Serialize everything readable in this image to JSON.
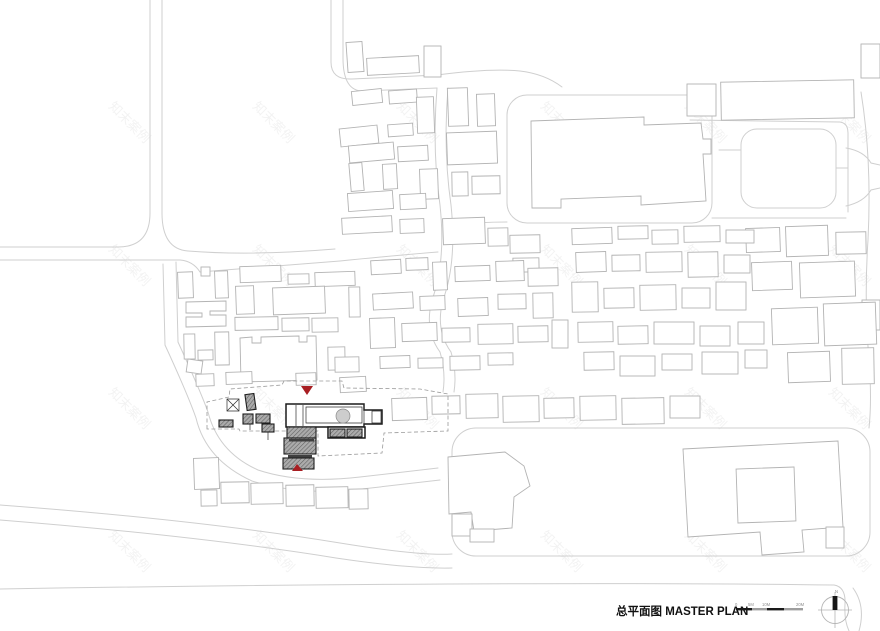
{
  "meta": {
    "title": "总平面图 MASTER PLAN"
  },
  "colors": {
    "accent_red": "#a81e22",
    "building_stroke": "#b3b3b3",
    "road_stroke": "#cfcfcf",
    "site_black": "#1a1a1a",
    "roof_gray": "#ababab"
  },
  "legend": {
    "north_label": "N",
    "scale_labels": [
      "0",
      "5M",
      "10M",
      "20M"
    ]
  },
  "watermark": {
    "text": "知末案例",
    "cols": [
      108,
      252,
      396,
      540,
      684,
      828
    ],
    "rows": [
      107,
      250,
      393,
      536
    ]
  },
  "map": {
    "layers": [
      {
        "name": "road",
        "cls": "road",
        "paths": [
          "M0,247 H118 Q150,247 150,213 V0",
          "M0,260 H180 Q193,261 200,272",
          "M162,0 V213 Q162,249 188,251 Q250,256 335,249",
          "M200,272 Q260,267 340,261 Q400,255 438,252",
          "M331,0 V62 Q331,80 352,79 L437,75",
          "M343,0 V58 Q343,92 364,91 L437,88",
          "M437,75 Q490,68 520,71 Q545,74 562,87",
          "M437,88 Q432,150 440,205 Q446,262 432,300 Q424,330 440,352",
          "M448,88 Q443,150 451,205 Q457,262 443,300 Q435,330 451,352",
          "M440,352 Q446,372 443,392",
          "M451,352 Q457,372 454,392",
          "M690,120 L840,122 Q848,123 848,133 V212",
          "M712,218 L846,218",
          "M451,225 Q480,222 507,222",
          "M846,148 Q864,151 871,163 L880,165",
          "M846,206 Q864,202 871,190 L880,188",
          "M861,92 Q872,160 868,240 Q864,300 869,360 Q872,400 869,428",
          "M176,262 Q177,305 178,342",
          "M163,264 Q164,308 165,345",
          "M178,342 Q200,390 208,412 Q218,452 258,470 Q300,484 360,477 L438,468",
          "M165,345 Q188,395 196,418 Q206,460 252,481 Q300,496 362,489 L440,480",
          "M0,505 Q200,520 340,543 Q420,556 452,554",
          "M0,520 Q200,536 336,558 Q410,569 452,568",
          "M719,150 H741",
          "M836,168 H848",
          "M0,589 C300,584 620,582 834,585 Q846,587 845,604 Q844,620 849,631",
          "M853,588 Q866,606 859,631"
        ],
        "rects": [
          [
            507,
            95,
            205,
            128,
            0,
            20
          ],
          [
            741,
            129,
            95,
            79,
            0,
            16
          ],
          [
            452,
            428,
            418,
            128,
            0,
            24
          ]
        ]
      },
      {
        "name": "building-footprint",
        "cls": "bldg",
        "rects": [
          [
            347,
            42,
            16,
            30,
            -4
          ],
          [
            367,
            57,
            52,
            17,
            -3
          ],
          [
            424,
            46,
            17,
            31,
            0
          ],
          [
            352,
            90,
            30,
            14,
            -6
          ],
          [
            389,
            90,
            28,
            13,
            -4
          ],
          [
            417,
            97,
            17,
            36,
            -2
          ],
          [
            340,
            127,
            38,
            18,
            -6
          ],
          [
            388,
            124,
            25,
            12,
            -4
          ],
          [
            349,
            144,
            45,
            17,
            -5
          ],
          [
            398,
            146,
            30,
            15,
            -3
          ],
          [
            350,
            163,
            13,
            28,
            -5
          ],
          [
            383,
            164,
            14,
            25,
            -3
          ],
          [
            420,
            169,
            18,
            30,
            -2
          ],
          [
            348,
            192,
            45,
            18,
            -4
          ],
          [
            400,
            194,
            26,
            15,
            -3
          ],
          [
            342,
            217,
            50,
            16,
            -3
          ],
          [
            400,
            219,
            24,
            14,
            -2
          ],
          [
            448,
            88,
            20,
            38,
            -2
          ],
          [
            477,
            94,
            18,
            32,
            -2
          ],
          [
            447,
            132,
            50,
            32,
            -2
          ],
          [
            452,
            172,
            16,
            24,
            -1
          ],
          [
            472,
            176,
            28,
            18,
            -1
          ],
          [
            443,
            218,
            42,
            26,
            -2
          ],
          [
            488,
            228,
            20,
            18,
            -1
          ],
          [
            510,
            235,
            30,
            18,
            -1
          ],
          [
            513,
            258,
            26,
            14,
            -1
          ],
          [
            687,
            84,
            29,
            32,
            0
          ],
          [
            721,
            81,
            133,
            38,
            -1
          ],
          [
            861,
            44,
            19,
            34,
            0
          ],
          [
            746,
            228,
            34,
            24,
            -2
          ],
          [
            786,
            226,
            42,
            30,
            -2
          ],
          [
            836,
            232,
            30,
            22,
            -1
          ],
          [
            752,
            262,
            40,
            28,
            -2
          ],
          [
            800,
            262,
            55,
            35,
            -2
          ],
          [
            862,
            300,
            18,
            30,
            0
          ],
          [
            772,
            308,
            46,
            36,
            -2
          ],
          [
            824,
            303,
            52,
            42,
            -2
          ],
          [
            788,
            352,
            42,
            30,
            -2
          ],
          [
            842,
            348,
            32,
            36,
            -1
          ],
          [
            178,
            272,
            15,
            26,
            -2
          ],
          [
            201,
            267,
            9,
            9,
            0
          ],
          [
            215,
            271,
            13,
            27,
            -2
          ],
          [
            240,
            266,
            41,
            16,
            -2
          ],
          [
            288,
            274,
            21,
            10,
            -1
          ],
          [
            315,
            272,
            40,
            14,
            -2
          ],
          [
            236,
            286,
            18,
            28,
            -2
          ],
          [
            273,
            287,
            52,
            27,
            -2
          ],
          [
            349,
            287,
            11,
            30,
            -1
          ],
          [
            235,
            317,
            43,
            13,
            -1
          ],
          [
            282,
            318,
            27,
            13,
            -1
          ],
          [
            312,
            318,
            26,
            14,
            -1
          ],
          [
            184,
            334,
            11,
            25,
            -1
          ],
          [
            215,
            332,
            14,
            33,
            -1
          ],
          [
            198,
            350,
            15,
            10,
            -1
          ],
          [
            187,
            360,
            15,
            13,
            8
          ],
          [
            328,
            347,
            17,
            23,
            -1
          ],
          [
            335,
            357,
            24,
            15,
            -1
          ],
          [
            371,
            260,
            30,
            14,
            -3
          ],
          [
            406,
            258,
            22,
            12,
            -2
          ],
          [
            433,
            262,
            14,
            28,
            -2
          ],
          [
            455,
            266,
            35,
            15,
            -2
          ],
          [
            496,
            261,
            28,
            20,
            -2
          ],
          [
            528,
            268,
            30,
            18,
            -1
          ],
          [
            373,
            293,
            40,
            16,
            -3
          ],
          [
            420,
            296,
            25,
            14,
            -2
          ],
          [
            458,
            298,
            30,
            18,
            -2
          ],
          [
            498,
            294,
            28,
            15,
            -1
          ],
          [
            533,
            293,
            20,
            25,
            -1
          ],
          [
            370,
            318,
            25,
            30,
            -2
          ],
          [
            402,
            323,
            35,
            18,
            -2
          ],
          [
            442,
            328,
            28,
            14,
            -1
          ],
          [
            478,
            324,
            35,
            20,
            -1
          ],
          [
            518,
            326,
            30,
            16,
            -1
          ],
          [
            552,
            320,
            16,
            28,
            0
          ],
          [
            380,
            356,
            30,
            12,
            -2
          ],
          [
            418,
            358,
            25,
            10,
            -1
          ],
          [
            450,
            356,
            30,
            14,
            -1
          ],
          [
            488,
            353,
            25,
            12,
            -1
          ],
          [
            392,
            398,
            35,
            22,
            -2
          ],
          [
            432,
            396,
            28,
            18,
            -1
          ],
          [
            466,
            394,
            32,
            24,
            -1
          ],
          [
            503,
            396,
            36,
            26,
            -1
          ],
          [
            544,
            398,
            30,
            20,
            -1
          ],
          [
            580,
            396,
            36,
            24,
            -1
          ],
          [
            622,
            398,
            42,
            26,
            -1
          ],
          [
            670,
            396,
            30,
            22,
            0
          ],
          [
            572,
            228,
            40,
            16,
            -2
          ],
          [
            618,
            226,
            30,
            13,
            -1
          ],
          [
            652,
            230,
            26,
            14,
            -1
          ],
          [
            684,
            226,
            36,
            16,
            -1
          ],
          [
            726,
            230,
            28,
            13,
            0
          ],
          [
            576,
            252,
            30,
            20,
            -2
          ],
          [
            612,
            255,
            28,
            16,
            -1
          ],
          [
            646,
            252,
            36,
            20,
            -1
          ],
          [
            688,
            252,
            30,
            25,
            -1
          ],
          [
            724,
            255,
            26,
            18,
            0
          ],
          [
            572,
            282,
            26,
            30,
            -1
          ],
          [
            604,
            288,
            30,
            20,
            -1
          ],
          [
            640,
            285,
            36,
            25,
            -1
          ],
          [
            682,
            288,
            28,
            20,
            0
          ],
          [
            716,
            282,
            30,
            28,
            0
          ],
          [
            578,
            322,
            35,
            20,
            -1
          ],
          [
            618,
            326,
            30,
            18,
            -1
          ],
          [
            654,
            322,
            40,
            22,
            0
          ],
          [
            700,
            326,
            30,
            20,
            0
          ],
          [
            738,
            322,
            26,
            22,
            0
          ],
          [
            584,
            352,
            30,
            18,
            -1
          ],
          [
            620,
            356,
            35,
            20,
            0
          ],
          [
            662,
            354,
            30,
            16,
            0
          ],
          [
            702,
            352,
            36,
            22,
            0
          ],
          [
            745,
            350,
            22,
            18,
            0
          ],
          [
            196,
            374,
            18,
            12,
            -2
          ],
          [
            226,
            372,
            26,
            12,
            -2
          ],
          [
            296,
            373,
            20,
            12,
            -2
          ],
          [
            340,
            377,
            26,
            15,
            -3
          ],
          [
            194,
            458,
            25,
            31,
            -2
          ],
          [
            201,
            490,
            16,
            16,
            -1
          ],
          [
            221,
            482,
            28,
            21,
            -1
          ],
          [
            251,
            483,
            32,
            21,
            -1
          ],
          [
            286,
            485,
            28,
            21,
            -1
          ],
          [
            316,
            487,
            32,
            21,
            -1
          ],
          [
            349,
            489,
            19,
            20,
            -1
          ],
          [
            452,
            514,
            20,
            22,
            0
          ],
          [
            470,
            529,
            24,
            13,
            0
          ],
          [
            737,
            468,
            58,
            54,
            -2
          ],
          [
            826,
            527,
            18,
            21,
            0
          ]
        ],
        "paths": [
          "M531,121 L644,117 L644,125 L701,123 L703,139 L711,139 L711,154 L703,154 L706,201 L641,205 L641,196 L561,199 L561,208 L532,208 Z",
          "M186,302 L226,301 L226,311 L210,311 L210,315 L226,315 L226,326 L186,327 L186,317 L202,317 L202,313 L186,313 Z",
          "M240,338 L252,337 L252,343 L261,343 L261,337 L299,336 L299,342 L307,342 L307,336 L316,336 L317,380 L241,382 Z",
          "M448,457 L505,452 L524,466 L530,486 L514,497 L512,528 L474,531 L471,512 L449,514 Z",
          "M683,449 L838,441 L843,527 L802,530 L804,552 L762,555 L760,532 L688,537 Z"
        ]
      },
      {
        "name": "site-boundary",
        "cls": "dash",
        "paths": [
          "M207,429 L207,402 L229,397 L230,389 L282,385 L284,381 L342,381 L344,388 L420,389 L448,394 L448,431 L384,433 L382,453 L318,456 L318,431 L240,431 L239,429 Z",
          "M287,440 H316",
          "M286,453 H316"
        ]
      },
      {
        "name": "site-main-building",
        "cls": "blk",
        "paths": [
          "M286,404 L364,404 L364,410 L382,410 L382,424 L364,424 L364,427 L286,427 Z"
        ],
        "rects": [
          [
            328,
            427,
            37,
            11
          ]
        ]
      },
      {
        "name": "site-inner-lines",
        "cls": "thin",
        "paths": [
          "M296,405 V426",
          "M303,405 V426",
          "M364,404 V427",
          "M306,407 H362 V423 H306 Z",
          "M372,411 H381 V423 H372 Z",
          "M268,432 V440",
          "M250,424 V430",
          "M227,399 H239 V411 H227 Z",
          "M227,399 L239,411",
          "M239,399 L227,411"
        ]
      },
      {
        "name": "site-tree",
        "cls": "treec",
        "circles": [
          [
            343,
            416,
            7
          ]
        ]
      },
      {
        "name": "site-roof-hatch",
        "cls": "gray",
        "rects": [
          [
            287,
            427,
            29,
            11
          ],
          [
            284,
            438,
            32,
            16
          ],
          [
            283,
            458,
            31,
            11
          ],
          [
            246,
            394,
            9,
            16,
            -8
          ],
          [
            243,
            414,
            10,
            10
          ],
          [
            256,
            414,
            14,
            9
          ],
          [
            262,
            424,
            12,
            8
          ],
          [
            219,
            420,
            14,
            7
          ],
          [
            330,
            429,
            15,
            8
          ],
          [
            347,
            429,
            15,
            8
          ]
        ]
      },
      {
        "name": "site-dark-bars",
        "cls": "dark",
        "rects": [
          [
            289,
            439,
            25,
            2.5
          ],
          [
            288,
            455,
            24,
            2.5
          ]
        ]
      }
    ]
  }
}
